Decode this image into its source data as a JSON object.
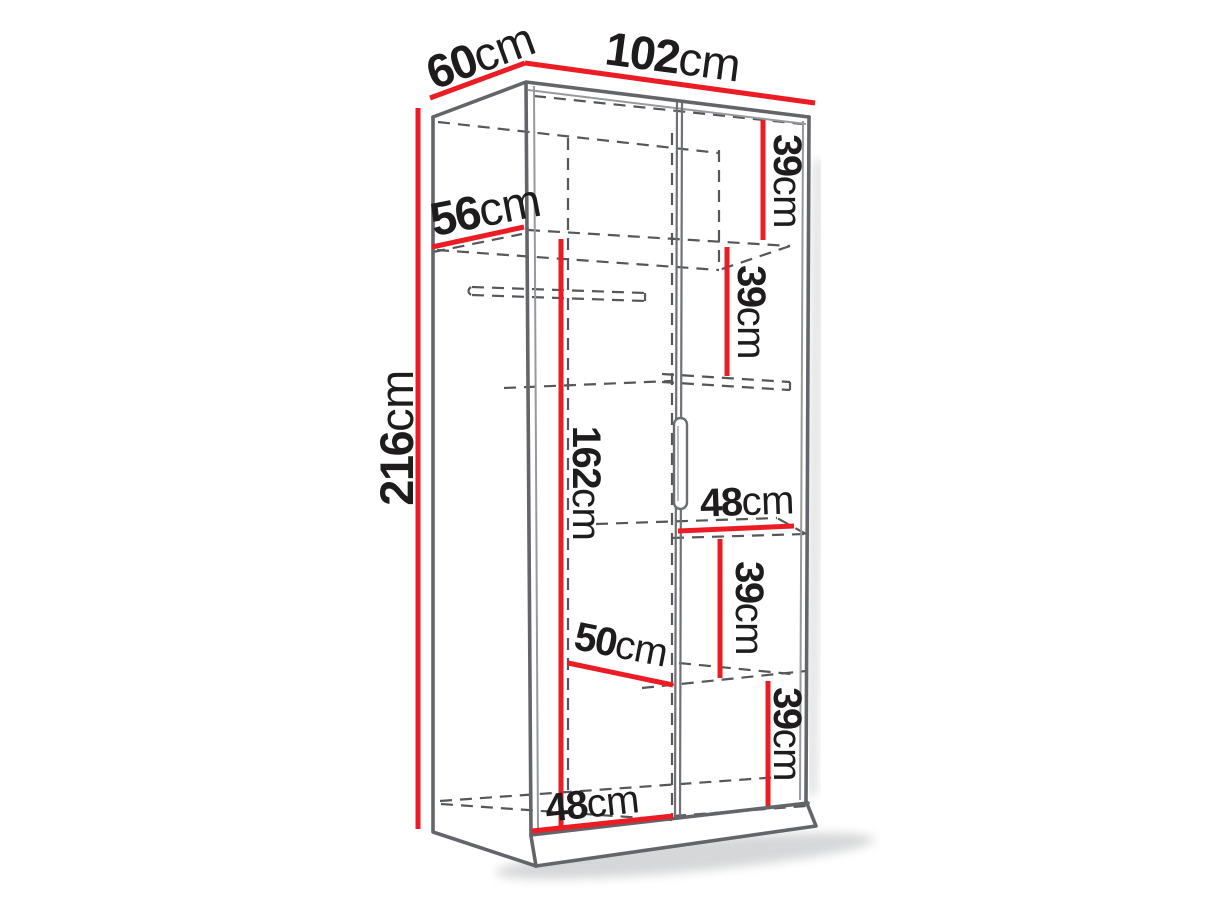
{
  "diagram": {
    "kind": "wardrobe-dimension-diagram",
    "colors": {
      "dimension": "#ec1c24",
      "outline": "#63656a",
      "hidden": "#55575a",
      "text": "#1e1c1d"
    },
    "labels": {
      "depth": {
        "value": "60",
        "unit": "cm"
      },
      "width": {
        "value": "102",
        "unit": "cm"
      },
      "height": {
        "value": "216",
        "unit": "cm"
      },
      "shelf_depth": {
        "value": "56",
        "unit": "cm"
      },
      "compartment_1": {
        "value": "39",
        "unit": "cm"
      },
      "compartment_2": {
        "value": "39",
        "unit": "cm"
      },
      "hanging_height": {
        "value": "162",
        "unit": "cm"
      },
      "middle_shelf_width": {
        "value": "48",
        "unit": "cm"
      },
      "compartment_3": {
        "value": "39",
        "unit": "cm"
      },
      "left_shelf_width": {
        "value": "50",
        "unit": "cm"
      },
      "compartment_4": {
        "value": "39",
        "unit": "cm"
      },
      "bottom_shelf_width": {
        "value": "48",
        "unit": "cm"
      }
    }
  }
}
